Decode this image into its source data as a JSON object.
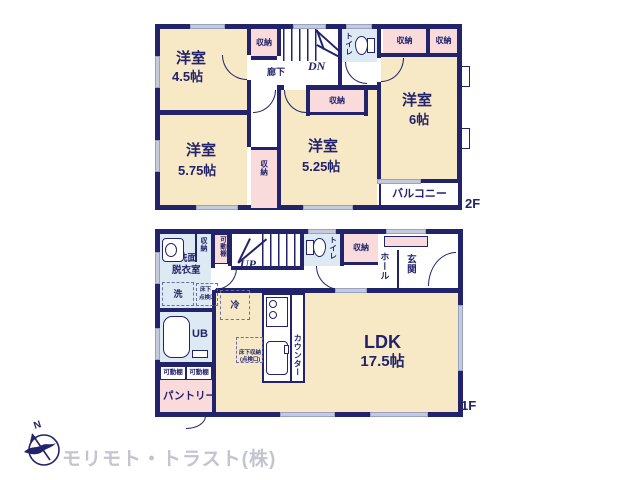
{
  "company": {
    "name": "モリモト・トラスト(株)"
  },
  "compass": {
    "north_label": "N"
  },
  "floor2": {
    "floor_label": "2F",
    "rooms": [
      {
        "name": "洋室",
        "size": "4.5帖"
      },
      {
        "name": "洋室",
        "size": "5.75帖"
      },
      {
        "name": "洋室",
        "size": "5.25帖"
      },
      {
        "name": "洋室",
        "size": "6帖"
      }
    ],
    "hallway": "廊下",
    "stairs_direction": "DN",
    "toilet": "トイレ",
    "balcony": "バルコニー",
    "closets": [
      "収納",
      "収納",
      "収納",
      "収納",
      "収納"
    ]
  },
  "floor1": {
    "floor_label": "1F",
    "ldk": {
      "name": "LDK",
      "size": "17.5帖"
    },
    "washroom": {
      "line1": "洗面",
      "line2": "脱衣室"
    },
    "washroom_closet": "収納",
    "movable_shelf_top": "可動棚",
    "stairs_direction": "UP",
    "toilet": "トイレ",
    "hall_closet": "収納",
    "hall": "ホール",
    "entrance": "玄関",
    "laundry": "洗",
    "floor_hatch": {
      "line1": "床下",
      "line2": "点検口"
    },
    "fridge": "冷",
    "bath": "UB",
    "shelves": [
      "可動棚",
      "可動棚"
    ],
    "pantry": "パントリー",
    "counter": "カウンター",
    "underfloor_storage": {
      "line1": "床下収納",
      "line2": "(点検口)"
    }
  }
}
